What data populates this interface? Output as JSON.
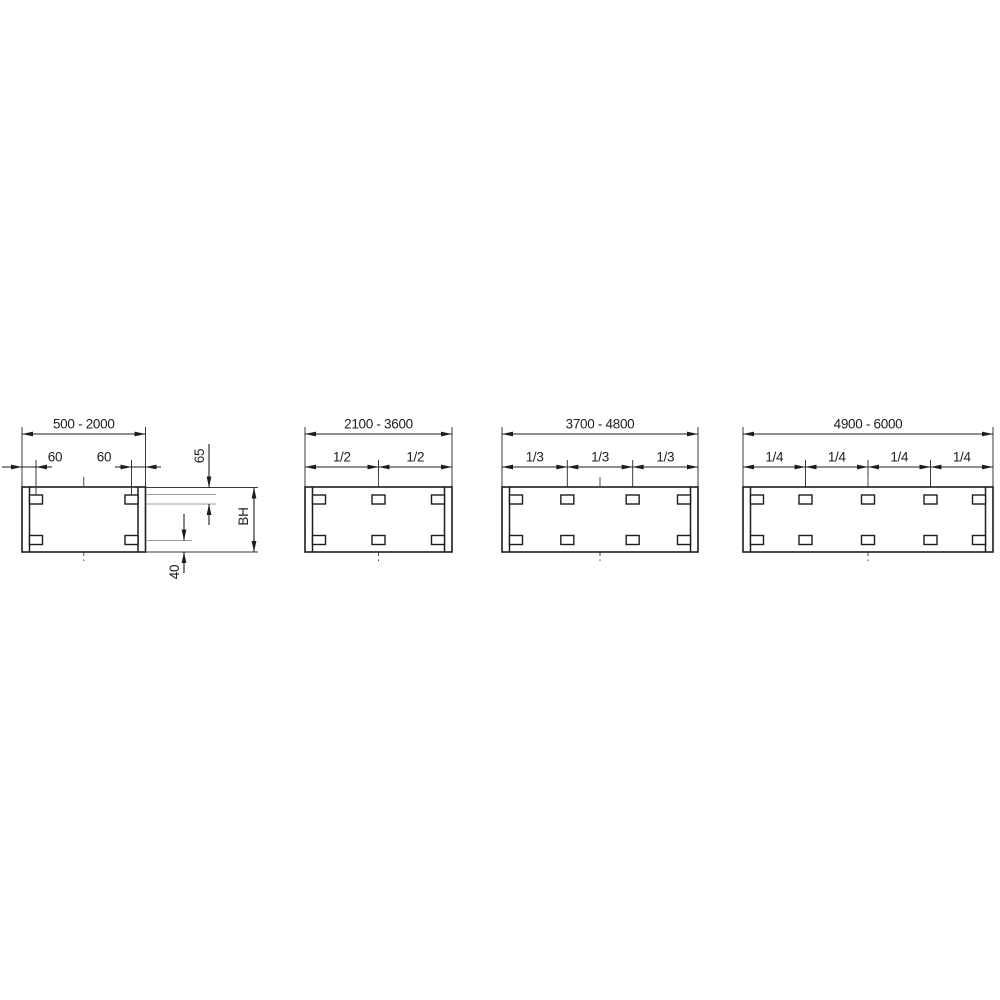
{
  "colors": {
    "background": "#ffffff",
    "line": "#1d1d1b",
    "extension": "#3a3a3a",
    "light": "#9c9c9c",
    "centerline": "#4a4a4a"
  },
  "diagrams": [
    {
      "range_label": "500 - 2000",
      "divisions": []
    },
    {
      "range_label": "2100 - 3600",
      "divisions": [
        "1/2",
        "1/2"
      ]
    },
    {
      "range_label": "3700 - 4800",
      "divisions": [
        "1/3",
        "1/3",
        "1/3"
      ]
    },
    {
      "range_label": "4900 - 6000",
      "divisions": [
        "1/4",
        "1/4",
        "1/4",
        "1/4"
      ]
    }
  ],
  "detail_dimensions": {
    "left_edge_to_bracket": "60",
    "bracket_to_right_edge": "60",
    "top_edge_to_bracket": "65",
    "height": "BH",
    "bracket_to_bottom_edge": "40"
  }
}
